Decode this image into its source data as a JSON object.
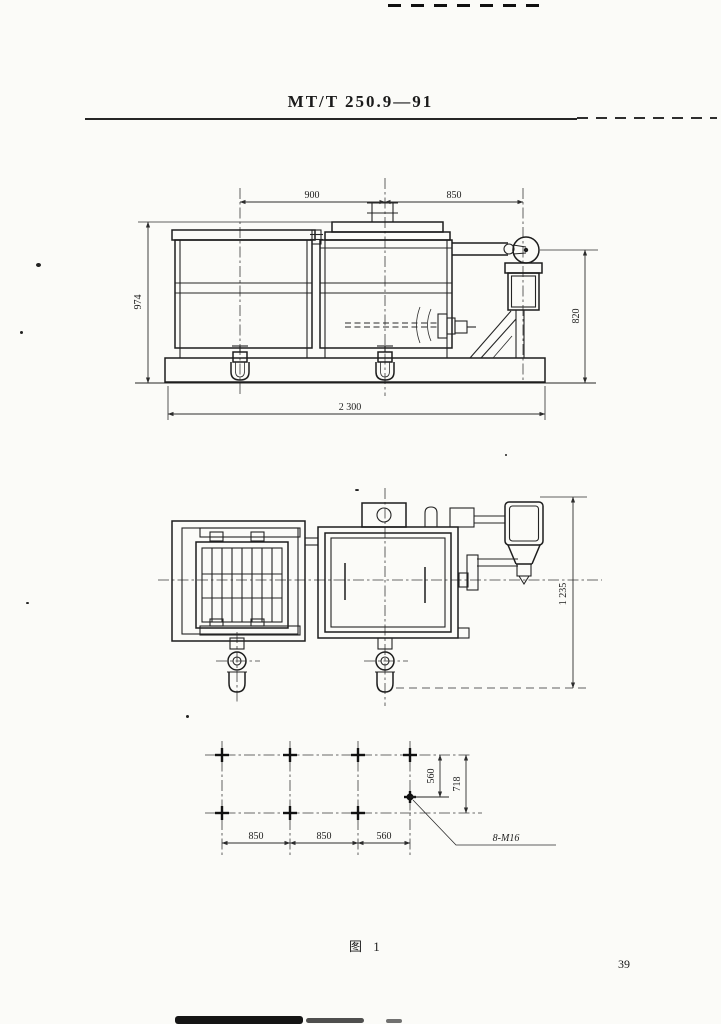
{
  "document": {
    "standard_number": "MT/T 250.9—91",
    "figure_caption": "图 1",
    "page_number": "39"
  },
  "front_view": {
    "dim_top_left": "900",
    "dim_top_right": "850",
    "dim_left_height": "974",
    "dim_right_height": "820",
    "dim_bottom_width": "2 300"
  },
  "plan_view": {
    "dim_right_height": "1 235"
  },
  "foundation_plan": {
    "dim_bottom_1": "850",
    "dim_bottom_2": "850",
    "dim_bottom_3": "560",
    "dim_right_inner": "560",
    "dim_right_outer": "718",
    "bolt_callout": "8-M16"
  }
}
